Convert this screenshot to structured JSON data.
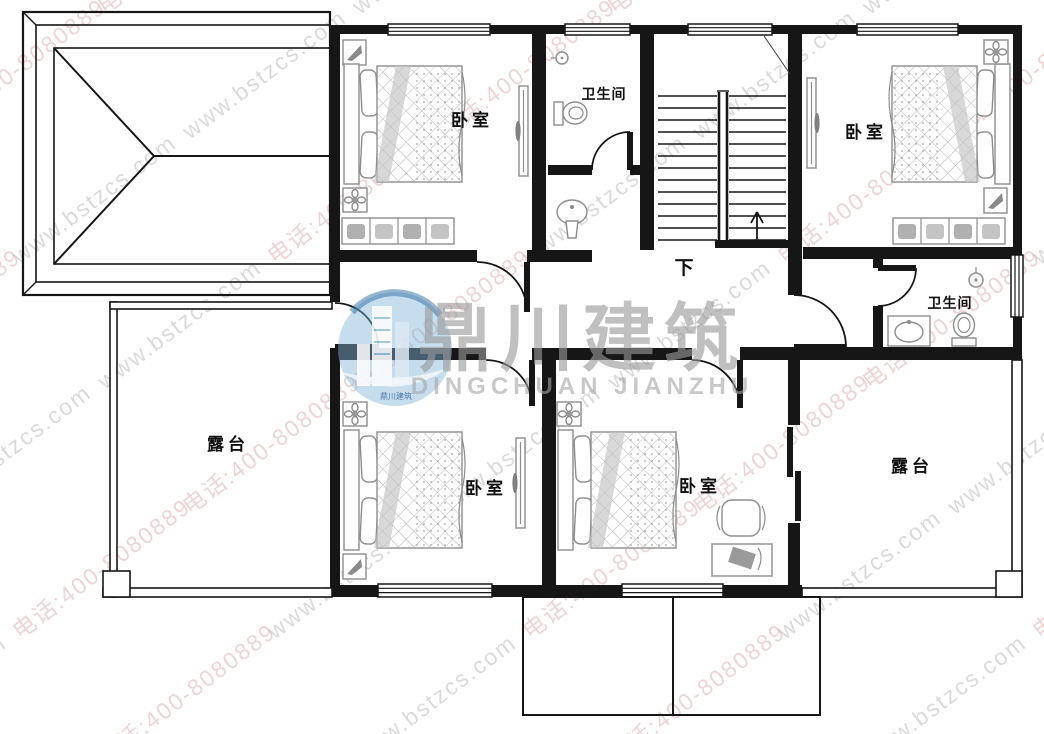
{
  "page": {
    "background": "#ffffff"
  },
  "watermark": {
    "site_text": "www.bstzcs.com",
    "phone_text": "电话:400-8080889",
    "site_color": "#bdbdbd",
    "phone_color": "#e2b0b6"
  },
  "logo": {
    "name_cn": "鼎川建筑",
    "name_en": "DINGCHUAN JIANZHU",
    "badge_text": "鼎川建筑",
    "circle_color": "#7fb3d5",
    "text_color": "#9a9a9a"
  },
  "rooms": {
    "bedroom_top_left": {
      "label": "卧室"
    },
    "bedroom_top_right": {
      "label": "卧室"
    },
    "bedroom_bottom_left": {
      "label": "卧室"
    },
    "bedroom_bottom_middle": {
      "label": "卧室"
    },
    "bathroom_top": {
      "label": "卫生间"
    },
    "bathroom_right": {
      "label": "卫生间"
    },
    "terrace_left": {
      "label": "露台"
    },
    "terrace_right": {
      "label": "露台"
    }
  },
  "stairs": {
    "down_label": "下"
  }
}
